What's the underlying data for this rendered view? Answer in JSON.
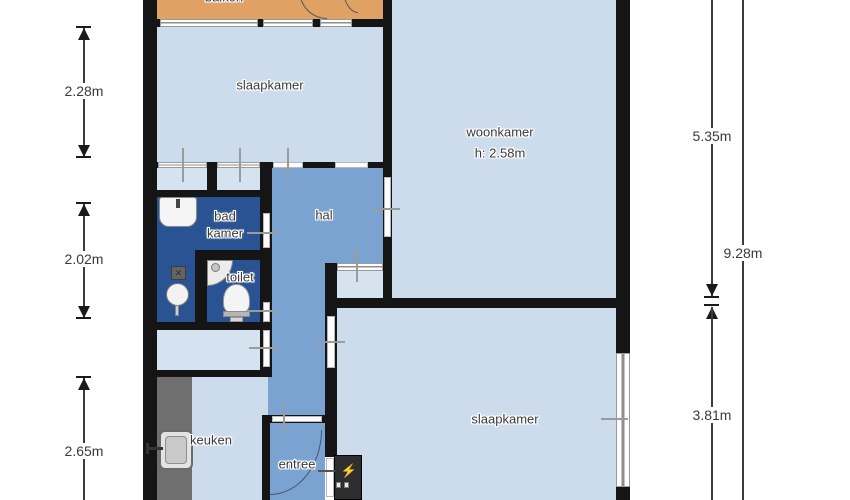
{
  "plan": {
    "rooms": {
      "balkon": "balkon",
      "slaapkamer_top": "slaapkamer",
      "woonkamer": "woonkamer",
      "woonkamer_height": "h: 2.58m",
      "badkamer_line1": "bad",
      "badkamer_line2": "kamer",
      "toilet": "toilet",
      "hal": "hal",
      "keuken": "keuken",
      "entree": "entree",
      "slaapkamer_bottom": "slaapkamer"
    },
    "dims": {
      "left": [
        {
          "label": "2.28m"
        },
        {
          "label": "2.02m"
        },
        {
          "label": "2.65m"
        }
      ],
      "right": [
        {
          "label": "5.35m"
        },
        {
          "label": "9.28m"
        },
        {
          "label": "3.81m"
        }
      ]
    },
    "fixtures": {
      "lightning_bolt": "⚡",
      "drain_cross": "✕"
    },
    "colors": {
      "room_light_blue": "#cddcec",
      "closet_light_blue": "#d5e2ef",
      "hall_blue": "#7aa3d2",
      "bathroom_dark_blue": "#2a5394",
      "balcony_orange": "#e0a164",
      "wall_black": "#151515",
      "counter_gray": "#6f6f6f",
      "meter_bolt_yellow": "#f0c419"
    }
  }
}
